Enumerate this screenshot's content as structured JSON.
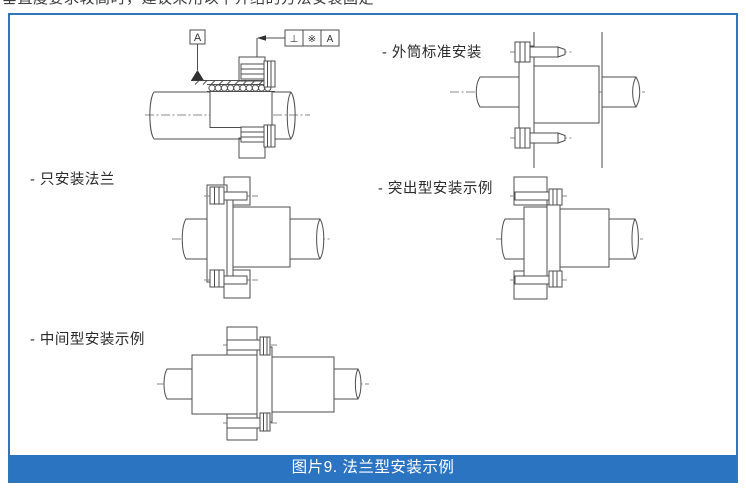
{
  "page": {
    "top_clipped_text": "垂直度要求较高时，建议采用以下介绍的方法安装固定",
    "caption": "图片9. 法兰型安装示例"
  },
  "figure": {
    "labels": {
      "outer_standard": "- 外筒标准安装",
      "flange_only": "- 只安装法兰",
      "protruding": "- 突出型安装示例",
      "intermediate": "- 中间型安装示例"
    },
    "annotations": {
      "datum_letter": "A",
      "tolerance_frame": {
        "symbol": "⊥",
        "value": "※",
        "datum": "A"
      }
    },
    "colors": {
      "border_blue": "#2f76bd",
      "caption_bg": "#2b74c2",
      "caption_text": "#ffffff",
      "drawing_line": "#4d4d4d"
    }
  }
}
